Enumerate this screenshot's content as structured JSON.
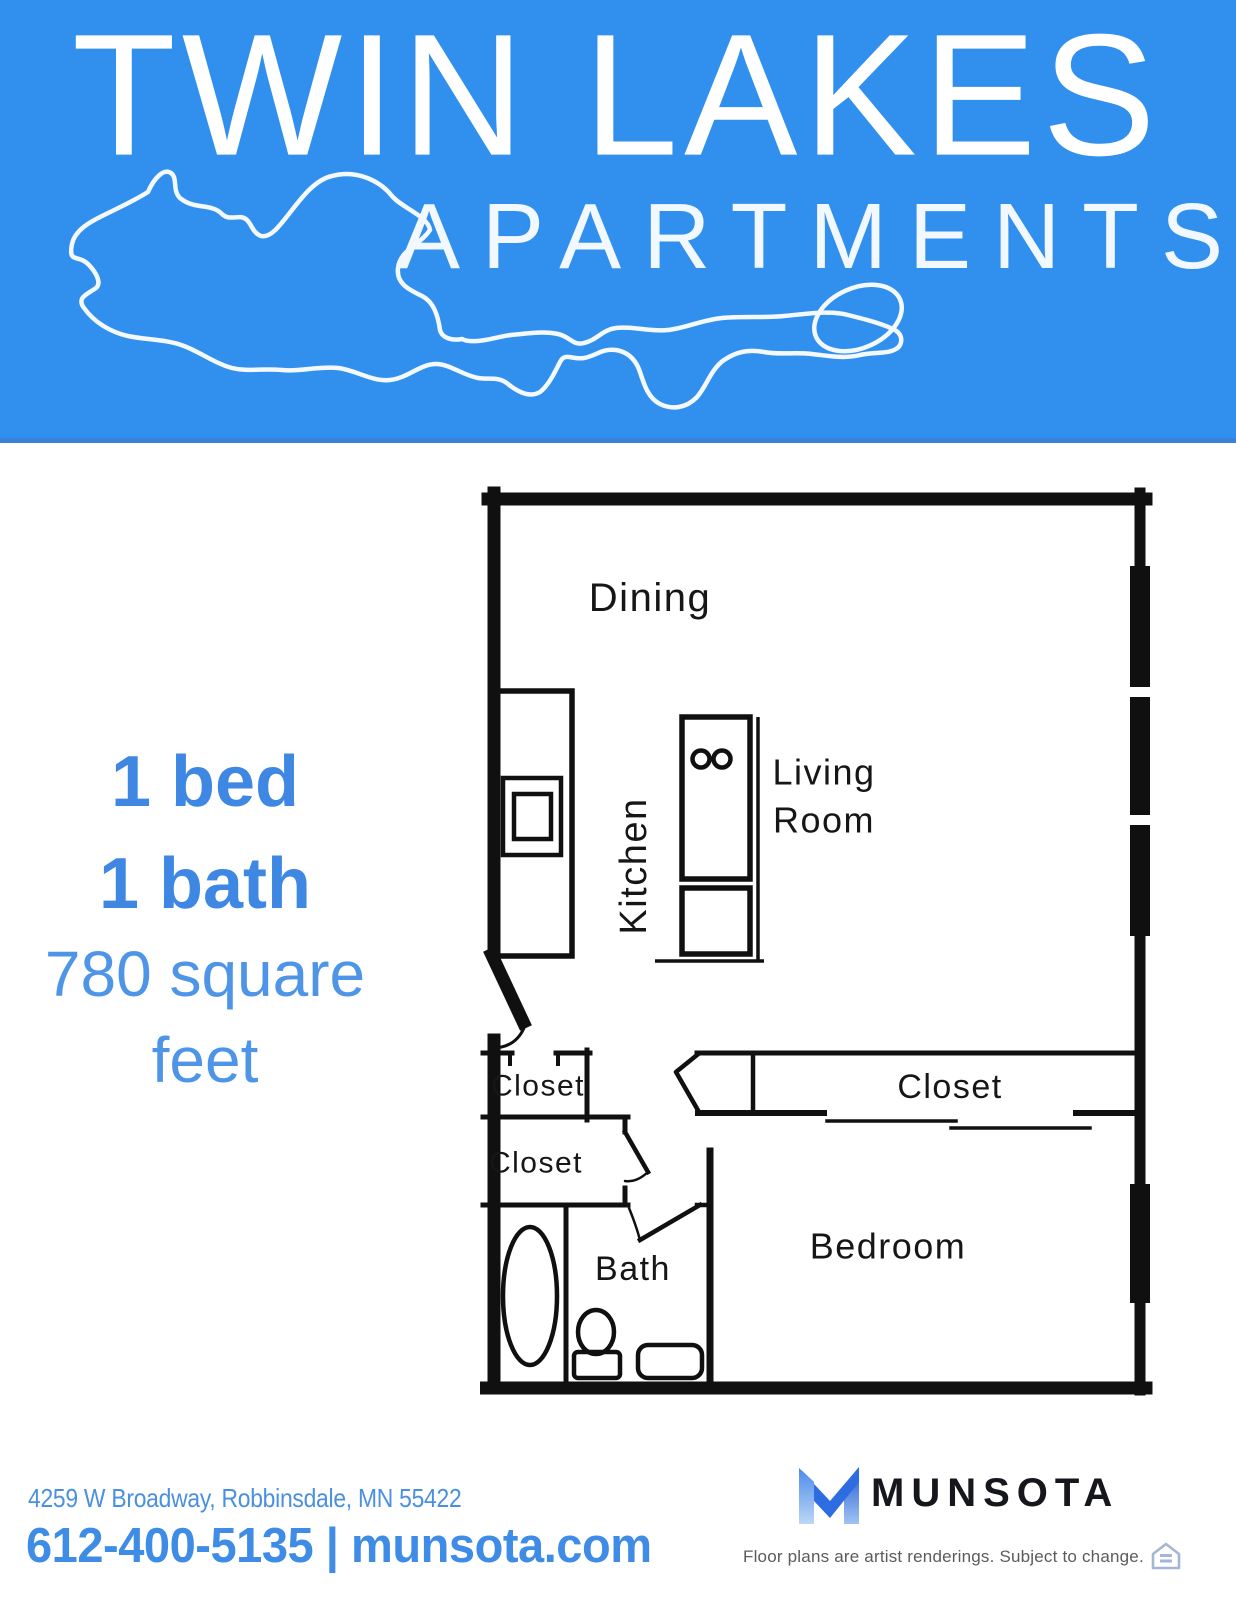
{
  "banner": {
    "title": "TWIN LAKES",
    "subtitle": "APARTMENTS",
    "bg_color": "#3190ee",
    "lake_icon": "twin-lakes-outline"
  },
  "unit": {
    "beds": "1 bed",
    "baths": "1 bath",
    "sqft_line1": "780 square",
    "sqft_line2": "feet",
    "accent_bold_color": "#3e87e2",
    "accent_light_color": "#4e95e8"
  },
  "floorplan": {
    "line_color": "#101010",
    "labels": {
      "dining": "Dining",
      "kitchen": "Kitchen",
      "living_line1": "Living",
      "living_line2": "Room",
      "closet_entry": "Closet",
      "closet_hall": "Closet",
      "closet_bedroom": "Closet",
      "bath": "Bath",
      "bedroom": "Bedroom"
    }
  },
  "footer": {
    "address": "4259 W Broadway, Robbinsdale, MN 55422",
    "contact": "612-400-5135 | munsota.com",
    "brand": "MUNSOTA",
    "disclaimer": "Floor plans are artist renderings. Subject to change.",
    "logo_icon": "munsota-m-logo",
    "equal_housing_icon": "equal-housing-opportunity",
    "address_color": "#4a90e2",
    "phone_color": "#3e8ce6"
  }
}
